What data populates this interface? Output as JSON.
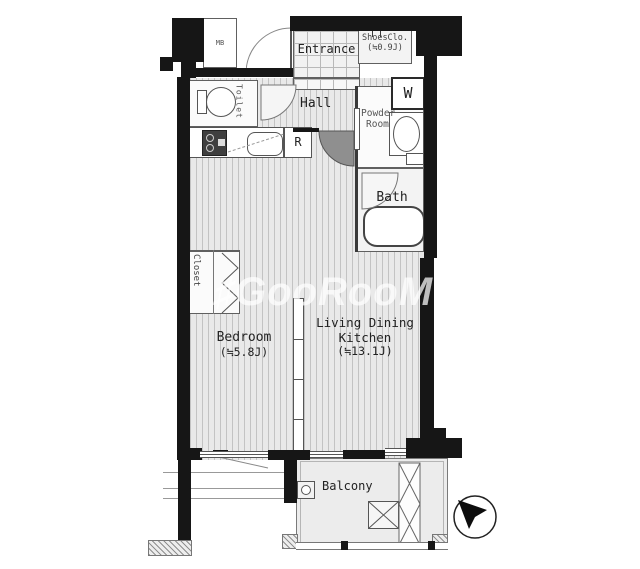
{
  "watermark": {
    "text": "♯GooRooM"
  },
  "compass": {
    "icon": "north-arrow-icon"
  },
  "rooms": {
    "mb": {
      "label": "MB"
    },
    "entrance": {
      "label": "Entrance"
    },
    "shoes_closet": {
      "line1": "ShoesClo.",
      "line2": "(≒0.9J)"
    },
    "toilet": {
      "label": "Toilet"
    },
    "hall": {
      "label": "Hall"
    },
    "washing_machine": {
      "label": "W"
    },
    "powder_room": {
      "line1": "Powder",
      "line2": "Room"
    },
    "refrigerator": {
      "label": "R"
    },
    "bath": {
      "label": "Bath"
    },
    "closet": {
      "label": "Closet"
    },
    "bedroom": {
      "label": "Bedroom",
      "size": "(≒5.8J)"
    },
    "living_dining_kitchen": {
      "line1": "Living Dining",
      "line2": "Kitchen",
      "size": "(≒13.1J)"
    },
    "balcony": {
      "label": "Balcony"
    }
  },
  "colors": {
    "wall": "#161616",
    "floor": "#e9e9e9",
    "floor_stripe": "#c3c3c3",
    "outline": "#606060",
    "watermark": "#ffffff"
  }
}
